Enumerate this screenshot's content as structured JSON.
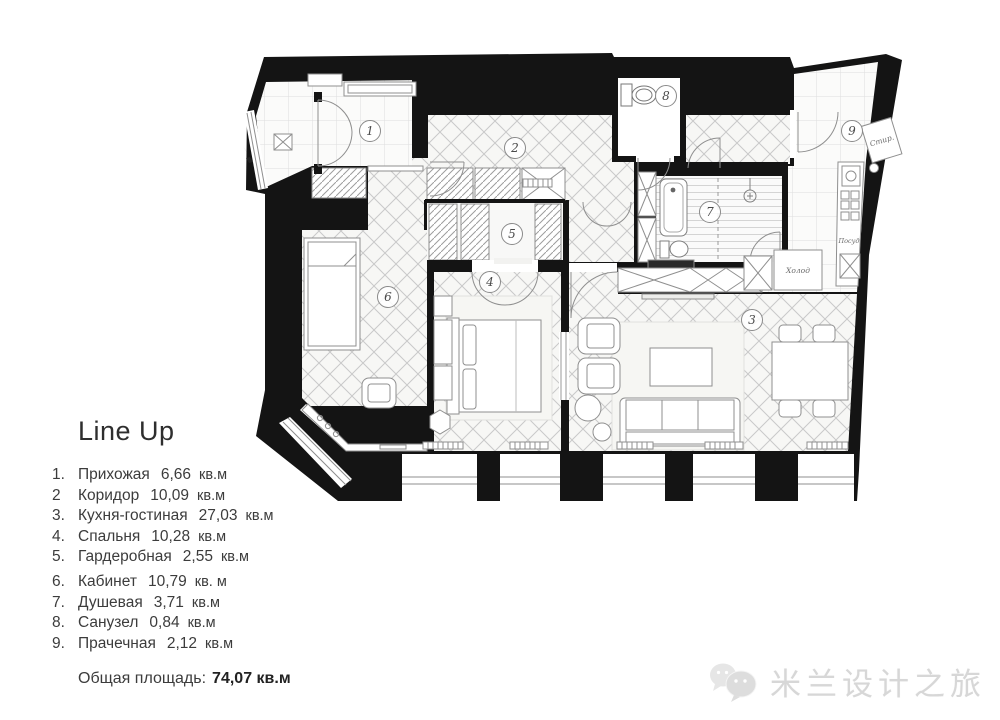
{
  "legend": {
    "title": "Line Up",
    "items": [
      {
        "num": "1.",
        "name": "Прихожая",
        "area": "6,66",
        "unit": "кв.м"
      },
      {
        "num": "2",
        "name": "Коридор",
        "area": "10,09",
        "unit": "кв.м"
      },
      {
        "num": "3.",
        "name": "Кухня-гостиная",
        "area": "27,03",
        "unit": "кв.м"
      },
      {
        "num": "4.",
        "name": "Спальня",
        "area": "10,28",
        "unit": "кв.м"
      },
      {
        "num": "5.",
        "name": "Гардеробная",
        "area": "2,55",
        "unit": "кв.м"
      },
      {
        "num": "6.",
        "name": "Кабинет",
        "area": "10,79",
        "unit": "кв. м"
      },
      {
        "num": "7.",
        "name": "Душевая",
        "area": "3,71",
        "unit": "кв.м"
      },
      {
        "num": "8.",
        "name": "Санузел",
        "area": "0,84",
        "unit": "кв.м"
      },
      {
        "num": "9.",
        "name": "Прачечная",
        "area": "2,12",
        "unit": "кв.м"
      }
    ],
    "total_label": "Общая площадь:",
    "total_value": "74,07 кв.м"
  },
  "plan": {
    "rooms": [
      {
        "num": "1"
      },
      {
        "num": "2"
      },
      {
        "num": "3"
      },
      {
        "num": "4"
      },
      {
        "num": "5"
      },
      {
        "num": "6"
      },
      {
        "num": "7"
      },
      {
        "num": "8"
      },
      {
        "num": "9"
      }
    ],
    "labels": {
      "fridge": "Холод",
      "washer": "Стир.",
      "dishwasher": "Посуд"
    }
  },
  "watermark": {
    "text": "米兰设计之旅",
    "icon": "wechat-bubbles-icon"
  },
  "colors": {
    "wall": "#141414",
    "pattern_line": "#c6c6c6",
    "legend_text": "#3c3c3c",
    "watermark": "#d7d7d7"
  }
}
